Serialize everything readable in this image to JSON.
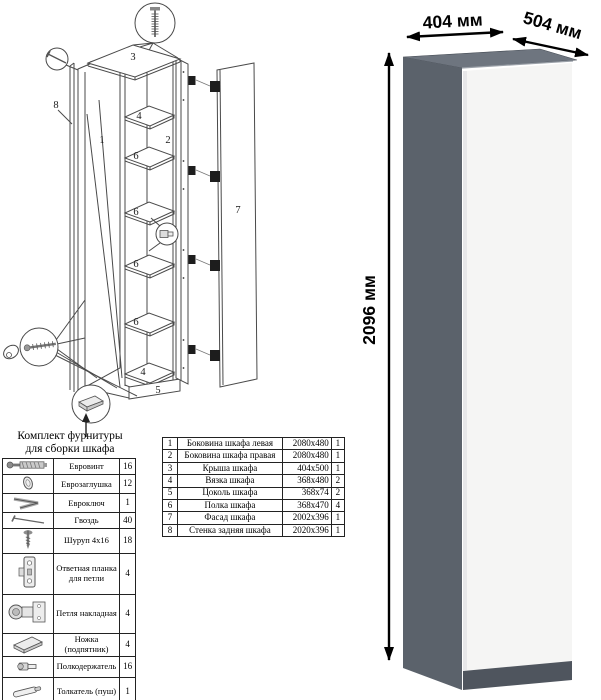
{
  "render": {
    "width_label": "404 мм",
    "depth_label": "504 мм",
    "height_label": "2096 мм",
    "colors": {
      "side": "#5b626b",
      "top": "#6e757f",
      "door": "#f5f5f4",
      "plinth": "#4f555e"
    }
  },
  "diagram": {
    "labels": {
      "l1": "1",
      "l2": "2",
      "l3": "3",
      "l4a": "4",
      "l4b": "4",
      "l5": "5",
      "l6a": "6",
      "l6b": "6",
      "l6c": "6",
      "l6d": "6",
      "l7": "7",
      "l8": "8"
    },
    "callout_icons": [
      "euro-screw-icon",
      "nail-icon",
      "confirmat-key-icon",
      "shelf-pin-icon",
      "foot-icon",
      "down-arrow-icon"
    ]
  },
  "hardware_kit": {
    "title_line1": "Комплект фурнитуры",
    "title_line2": "для сборки шкафа",
    "items": [
      {
        "icon": "euro-screw-icon",
        "name": "Евровинт",
        "qty": "16"
      },
      {
        "icon": "euro-cap-icon",
        "name": "Еврозаглушка",
        "qty": "12"
      },
      {
        "icon": "euro-key-icon",
        "name": "Евроключ",
        "qty": "1"
      },
      {
        "icon": "nail-icon",
        "name": "Гвоздь",
        "qty": "40"
      },
      {
        "icon": "wood-screw-icon",
        "name": "Шуруп 4x16",
        "qty": "18"
      },
      {
        "icon": "strike-plate-icon",
        "name": "Ответная планка для петли",
        "qty": "4"
      },
      {
        "icon": "hinge-icon",
        "name": "Петля накладная",
        "qty": "4"
      },
      {
        "icon": "foot-icon",
        "name": "Ножка (подпятник)",
        "qty": "4"
      },
      {
        "icon": "shelf-pin-icon",
        "name": "Полкодержатель",
        "qty": "16"
      },
      {
        "icon": "push-rod-icon",
        "name": "Толкатель (пуш)",
        "qty": "1"
      }
    ]
  },
  "parts_table": {
    "rows": [
      {
        "num": "1",
        "name": "Боковина шкафа левая",
        "size": "2080x480",
        "qty": "1"
      },
      {
        "num": "2",
        "name": "Боковина шкафа правая",
        "size": "2080x480",
        "qty": "1"
      },
      {
        "num": "3",
        "name": "Крыша шкафа",
        "size": "404x500",
        "qty": "1"
      },
      {
        "num": "4",
        "name": "Вязка шкафа",
        "size": "368x480",
        "qty": "2"
      },
      {
        "num": "5",
        "name": "Цоколь шкафа",
        "size": "368x74",
        "qty": "2"
      },
      {
        "num": "6",
        "name": "Полка шкафа",
        "size": "368x470",
        "qty": "4"
      },
      {
        "num": "7",
        "name": "Фасад шкафа",
        "size": "2002x396",
        "qty": "1"
      },
      {
        "num": "8",
        "name": "Стенка задняя шкафа",
        "size": "2020x396",
        "qty": "1"
      }
    ]
  }
}
